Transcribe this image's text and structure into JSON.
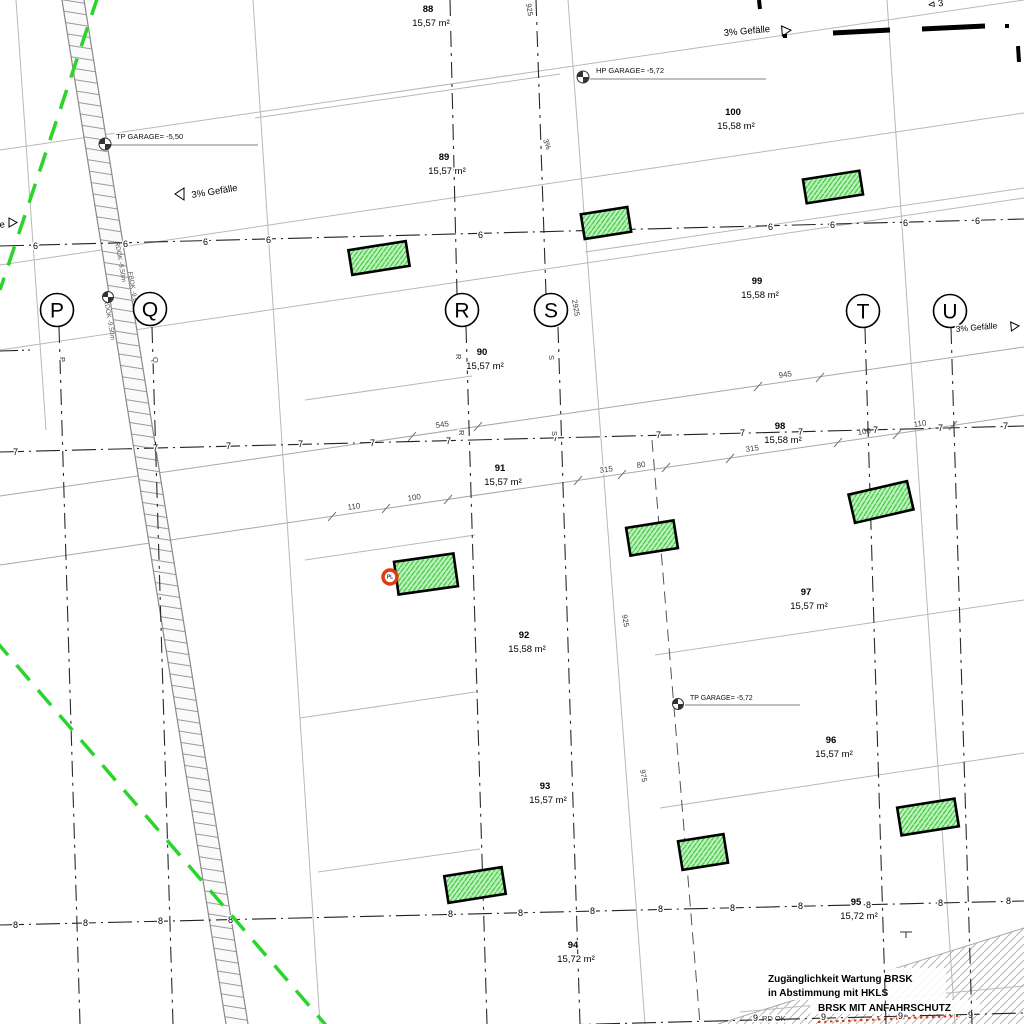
{
  "grid_axes": {
    "vertical": [
      {
        "label": "P"
      },
      {
        "label": "Q"
      },
      {
        "label": "R"
      },
      {
        "label": "S"
      },
      {
        "label": "T"
      },
      {
        "label": "U"
      }
    ],
    "horizontal": [
      {
        "label": "6"
      },
      {
        "label": "7"
      },
      {
        "label": "8"
      },
      {
        "label": "9"
      }
    ]
  },
  "stalls": [
    {
      "number": "88",
      "area": "15,57 m²"
    },
    {
      "number": "89",
      "area": "15,57 m²"
    },
    {
      "number": "90",
      "area": "15,57 m²"
    },
    {
      "number": "91",
      "area": "15,57 m²"
    },
    {
      "number": "92",
      "area": "15,58 m²"
    },
    {
      "number": "93",
      "area": "15,57 m²"
    },
    {
      "number": "94",
      "area": "15,72 m²"
    },
    {
      "number": "100",
      "area": "15,58 m²"
    },
    {
      "number": "99",
      "area": "15,58 m²"
    },
    {
      "number": "98",
      "area": "15,58 m²"
    },
    {
      "number": "97",
      "area": "15,57 m²"
    },
    {
      "number": "96",
      "area": "15,57 m²"
    },
    {
      "number": "95",
      "area": "15,72 m²"
    }
  ],
  "level_markers": [
    {
      "label": "TP GARAGE= -5,50"
    },
    {
      "label": "HP GARAGE= -5,72"
    },
    {
      "label": "TP GARAGE= -5,72"
    }
  ],
  "slope": {
    "label": "3% Gefälle",
    "fragment_left": "e",
    "fragment_top_right": "⊲ 3"
  },
  "dimensions": {
    "upper": [
      "545",
      "945"
    ],
    "lower": [
      "110",
      "100",
      "315",
      "80",
      "315",
      "100",
      "110"
    ],
    "vertical": [
      "2925",
      "925",
      "975",
      "925",
      "3%"
    ]
  },
  "ramp_texts": [
    "RDOK -9,50m",
    "FBOK -9,60m",
    "RDOK -9,50m"
  ],
  "notes": {
    "maintenance_1": "Zugänglichkeit Wartung BRSK",
    "maintenance_2": "in Abstimmung mit HKLS",
    "protection": "BRSK MIT ANFAHRSCHUTZ",
    "bottom_fragment": "RD OK"
  },
  "point_marker": {
    "label": "PL"
  },
  "colors": {
    "green_dashed": "#2bd42b",
    "stall_fill": "#bdf3bd",
    "stall_hatch": "#3fc63f",
    "marker_ring": "#e23b12",
    "hatch_gray": "#b5b5b5"
  }
}
